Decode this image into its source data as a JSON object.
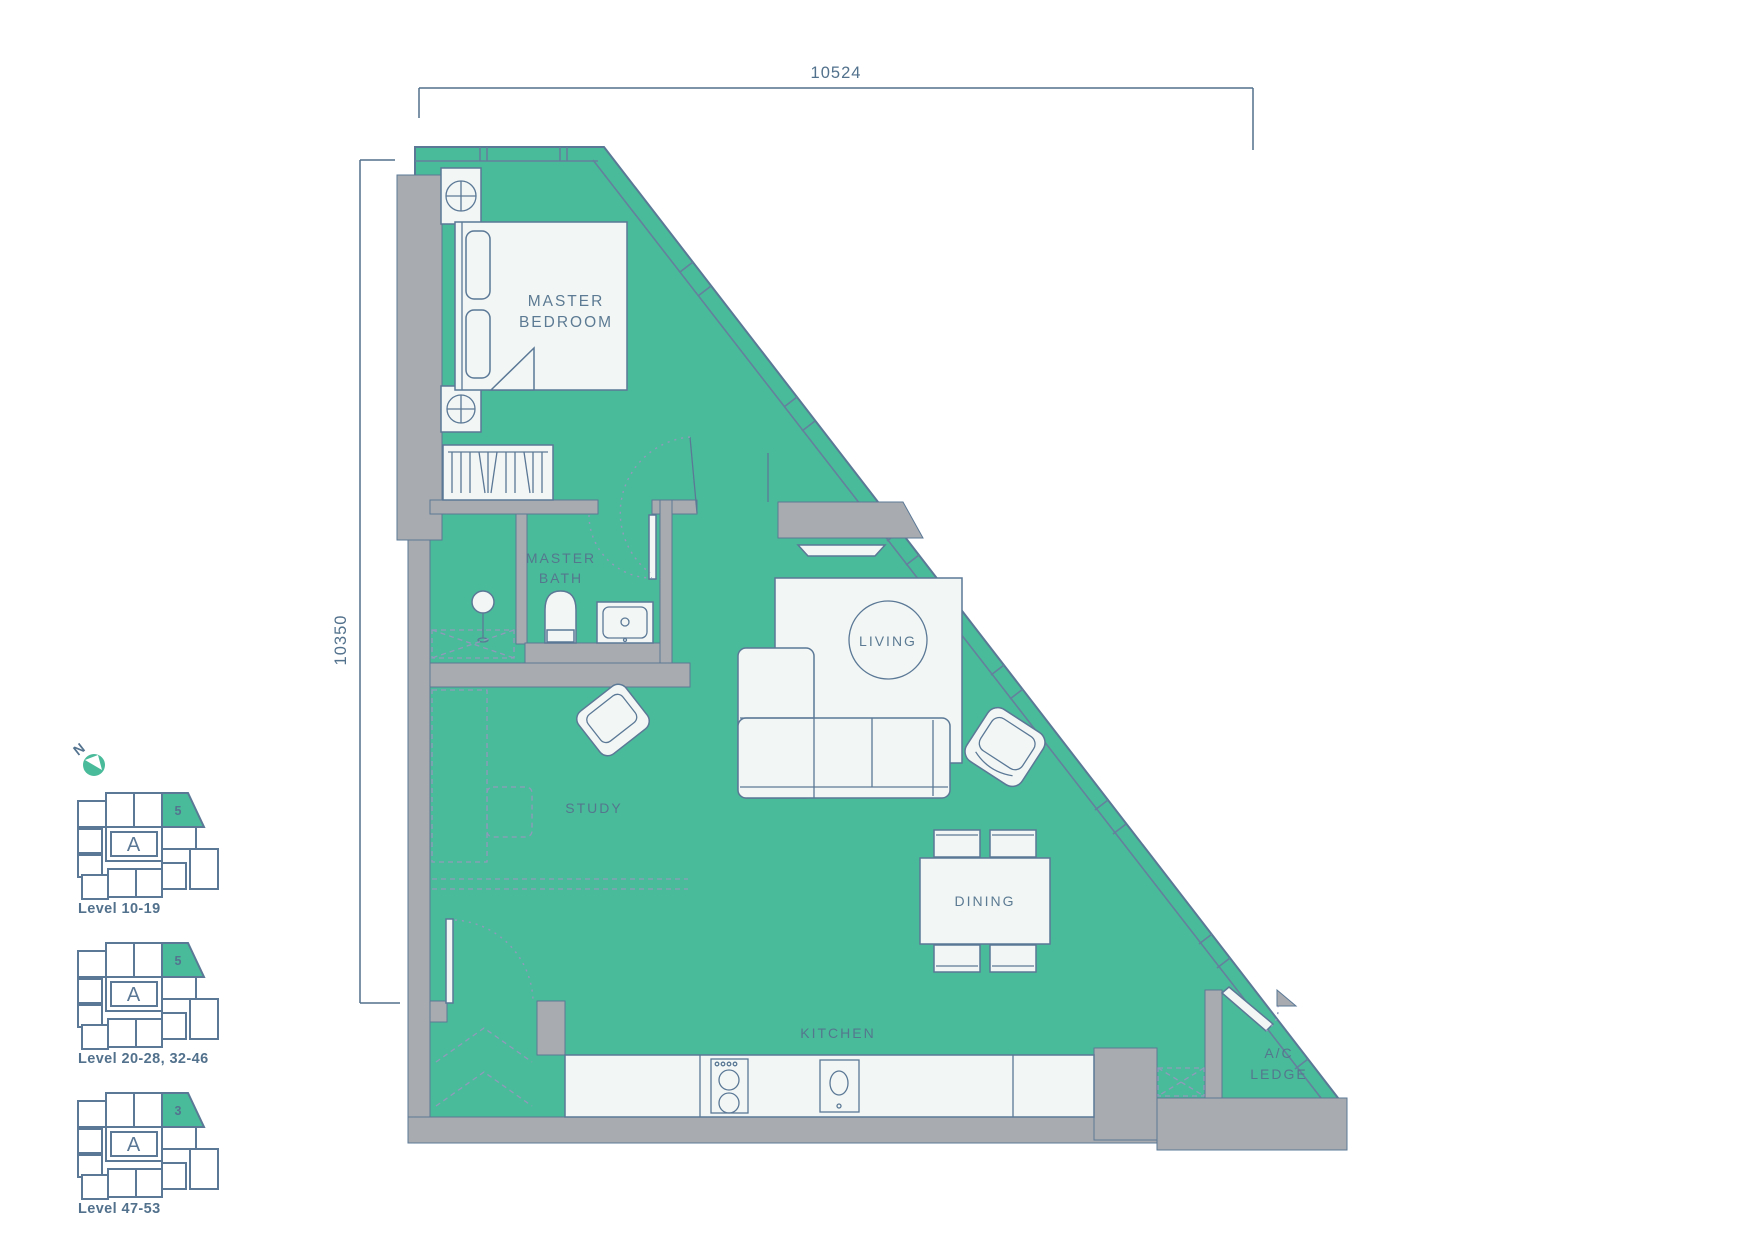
{
  "dimensions": {
    "top": "10524",
    "left": "10350"
  },
  "rooms": {
    "master_bedroom_line1": "MASTER",
    "master_bedroom_line2": "BEDROOM",
    "master_bath_line1": "MASTER",
    "master_bath_line2": "BATH",
    "study": "STUDY",
    "living": "LIVING",
    "dining": "DINING",
    "kitchen": "KITCHEN",
    "ac_ledge_line1": "A/C",
    "ac_ledge_line2": "LEDGE"
  },
  "compass": {
    "north_label": "N"
  },
  "key_plans": [
    {
      "tower": "A",
      "unit": "5",
      "caption": "Level 10-19"
    },
    {
      "tower": "A",
      "unit": "5",
      "caption": "Level 20-28, 32-46"
    },
    {
      "tower": "A",
      "unit": "3",
      "caption": "Level 47-53"
    }
  ],
  "colors": {
    "unit_fill": "#4abb9a",
    "wall_gray": "#a8acb0",
    "line_slate": "#5b7896",
    "dashed_accent": "#9099bb",
    "text_slate": "#52718c",
    "furniture_fill": "#f2f7f5"
  }
}
